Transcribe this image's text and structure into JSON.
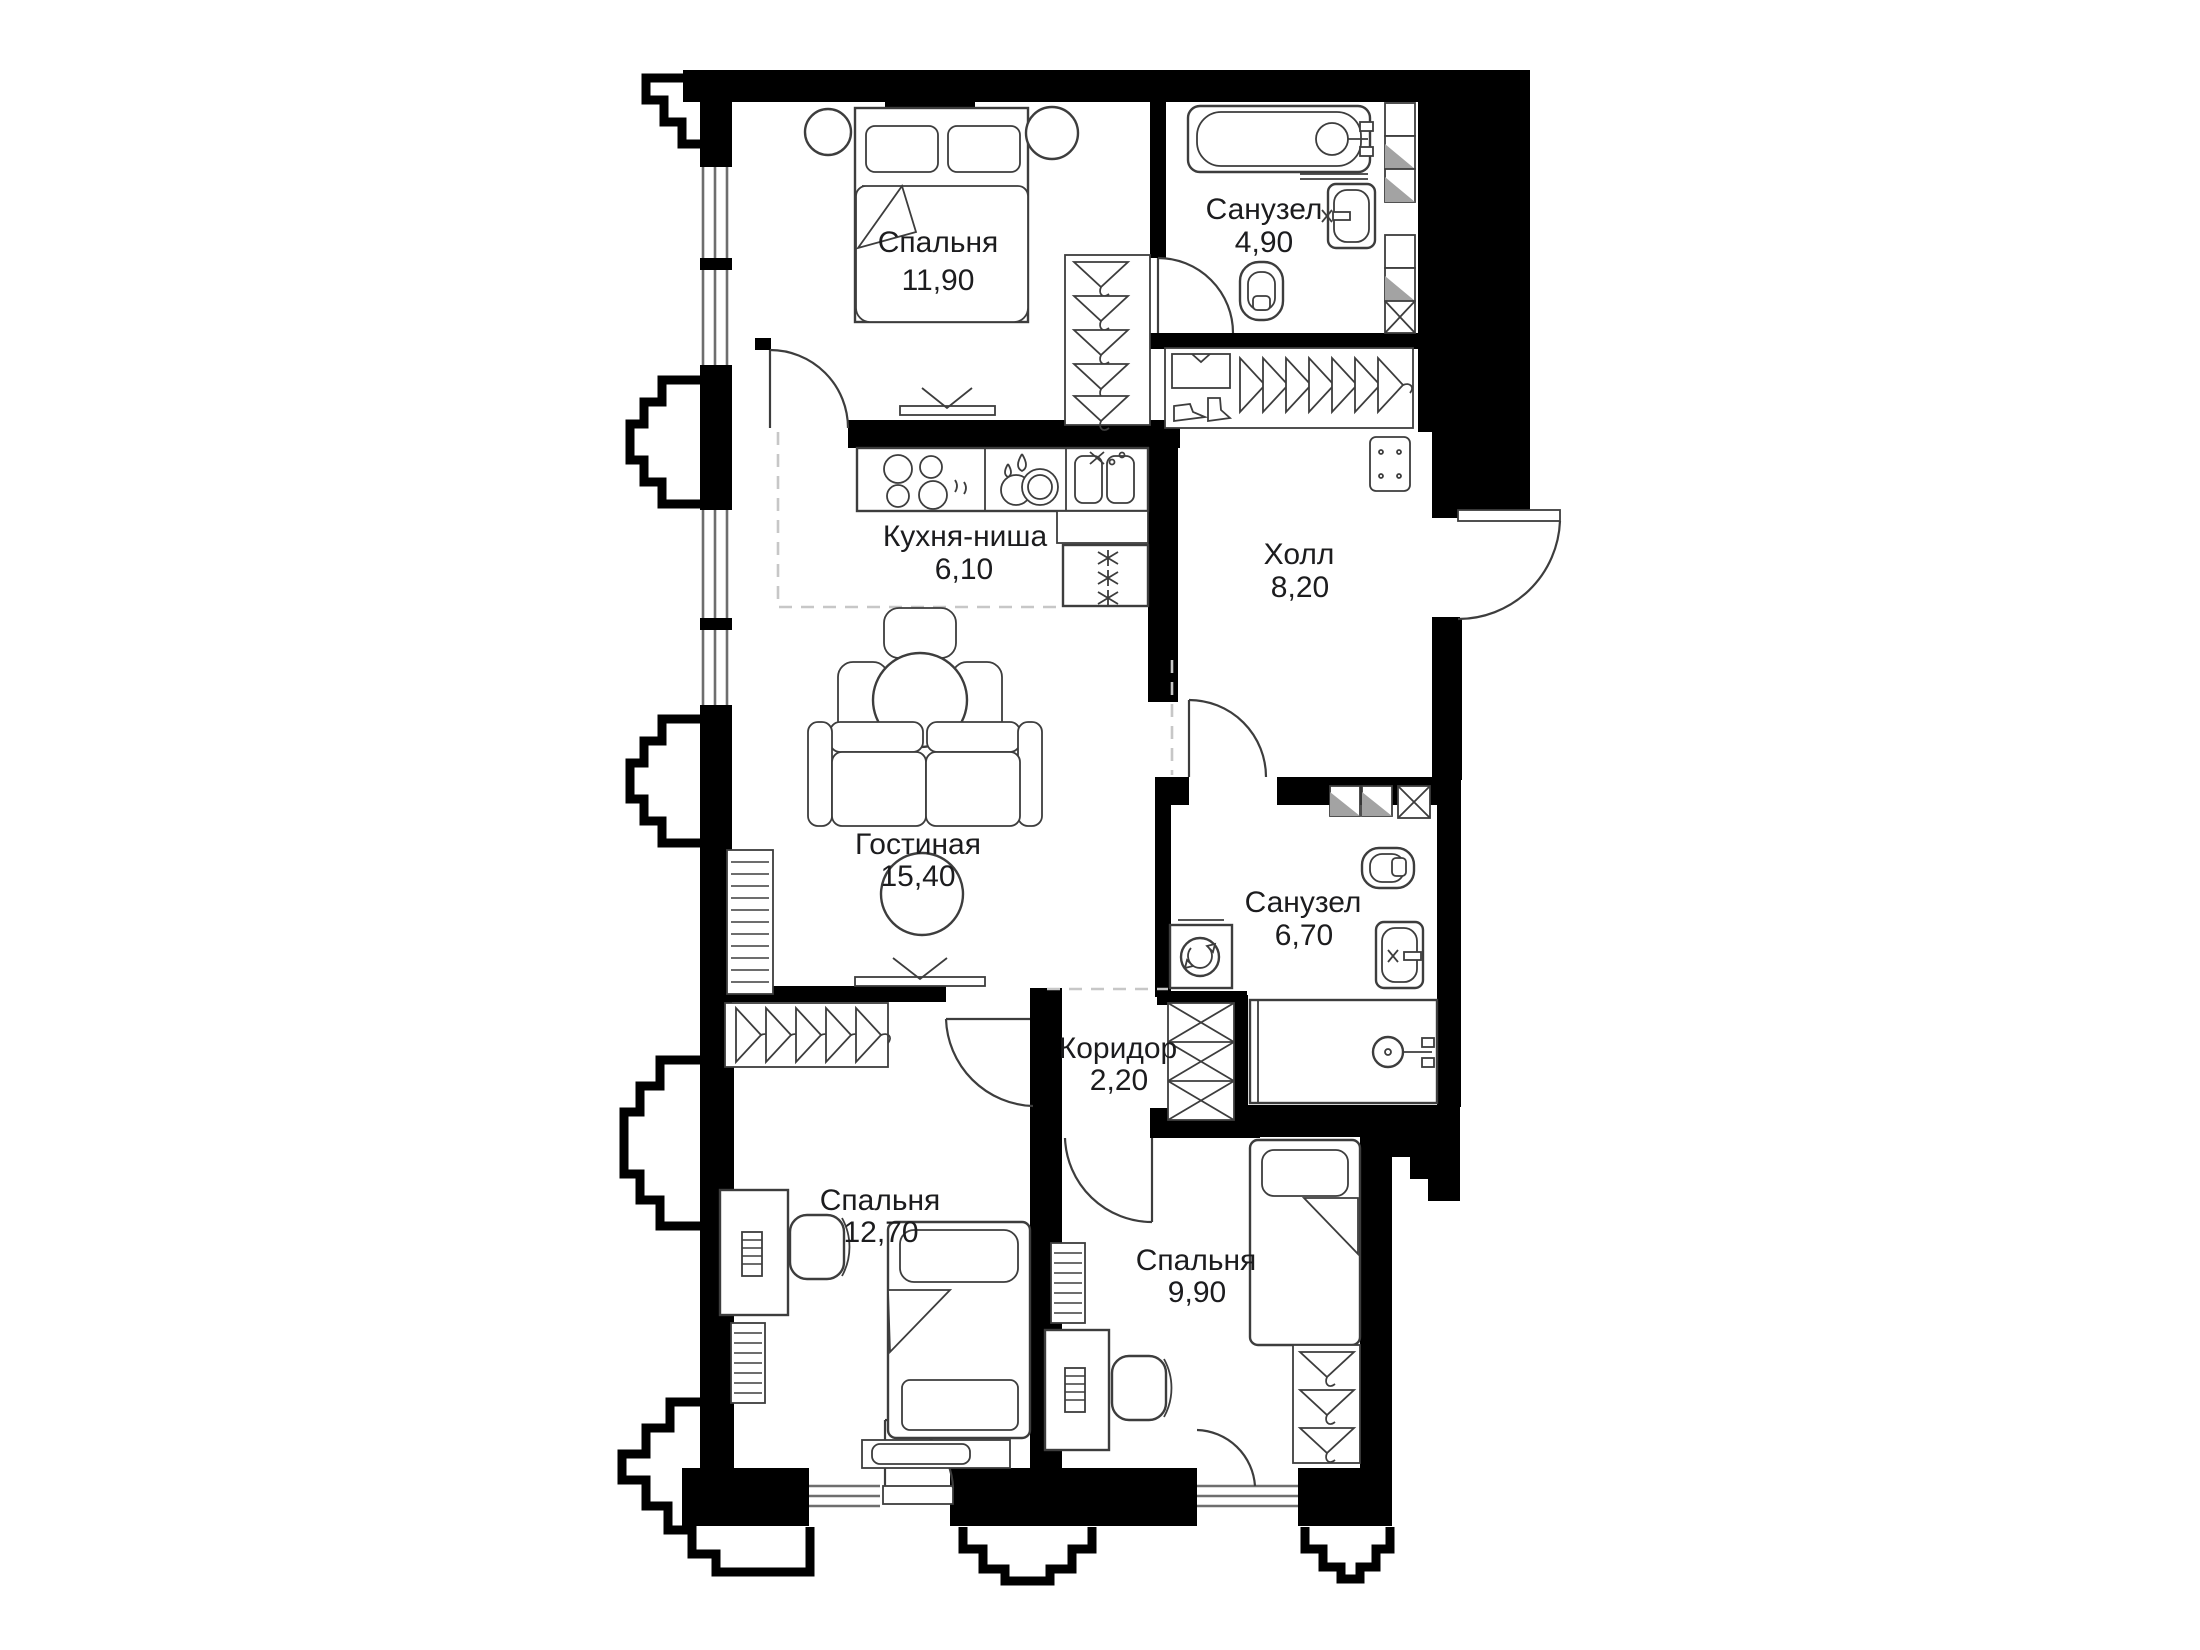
{
  "floor_plan": {
    "language": "ru",
    "colors": {
      "background": "#ffffff",
      "walls": "#000000",
      "furniture_lines": "#3d3d3d",
      "zone_dashes": "#c7c7c7",
      "label_text": "#1c1c1e",
      "towel_fill": "#a3a3a3"
    },
    "rooms": [
      {
        "id": "bedroom-1",
        "name": "Спальня",
        "area": "11,90"
      },
      {
        "id": "bathroom-1",
        "name": "Санузел",
        "area": "4,90"
      },
      {
        "id": "kitchen-niche",
        "name": "Кухня-ниша",
        "area": "6,10"
      },
      {
        "id": "hall",
        "name": "Холл",
        "area": "8,20"
      },
      {
        "id": "living-room",
        "name": "Гостиная",
        "area": "15,40"
      },
      {
        "id": "bathroom-2",
        "name": "Санузел",
        "area": "6,70"
      },
      {
        "id": "corridor",
        "name": "Коридор",
        "area": "2,20"
      },
      {
        "id": "bedroom-2",
        "name": "Спальня",
        "area": "12,70"
      },
      {
        "id": "bedroom-3",
        "name": "Спальня",
        "area": "9,90"
      }
    ],
    "fixtures": {
      "bedroom_1": [
        "double-bed-icon",
        "pillow-icon",
        "nightstand-icon",
        "wardrobe-hangers-icon",
        "tv-icon",
        "window-icon",
        "door-icon"
      ],
      "bathroom_1": [
        "bathtub-icon",
        "shower-mixer-icon",
        "washbasin-icon",
        "toilet-icon",
        "linen-shelves-icon",
        "door-icon"
      ],
      "kitchen": [
        "kitchen-counter-icon",
        "hob-icon",
        "dish-rack-icon",
        "double-sink-icon",
        "fridge-icon",
        "dining-table-icon",
        "chair-icon"
      ],
      "hall": [
        "entry-wardrobe-icon",
        "shirt-icon",
        "shoes-icon",
        "hanger-icon",
        "doormat-icon",
        "entrance-door-icon"
      ],
      "living_room": [
        "sofa-icon",
        "round-rug-icon",
        "tv-icon",
        "radiator-icon",
        "zone-dashed-line"
      ],
      "bathroom_2": [
        "washing-machine-icon",
        "toilet-icon",
        "washbasin-icon",
        "shower-icon",
        "towel-shelf-icon",
        "door-icon"
      ],
      "corridor": [
        "storage-closet-icon"
      ],
      "bedroom_2": [
        "single-bed-icon",
        "desk-icon",
        "office-chair-icon",
        "wardrobe-hangers-icon",
        "radiator-icon",
        "bench-icon",
        "balcony-door-icon"
      ],
      "bedroom_3": [
        "single-bed-icon",
        "nightstand-icon",
        "desk-icon",
        "office-chair-icon",
        "wardrobe-hangers-icon",
        "radiator-icon",
        "window-icon"
      ]
    }
  }
}
